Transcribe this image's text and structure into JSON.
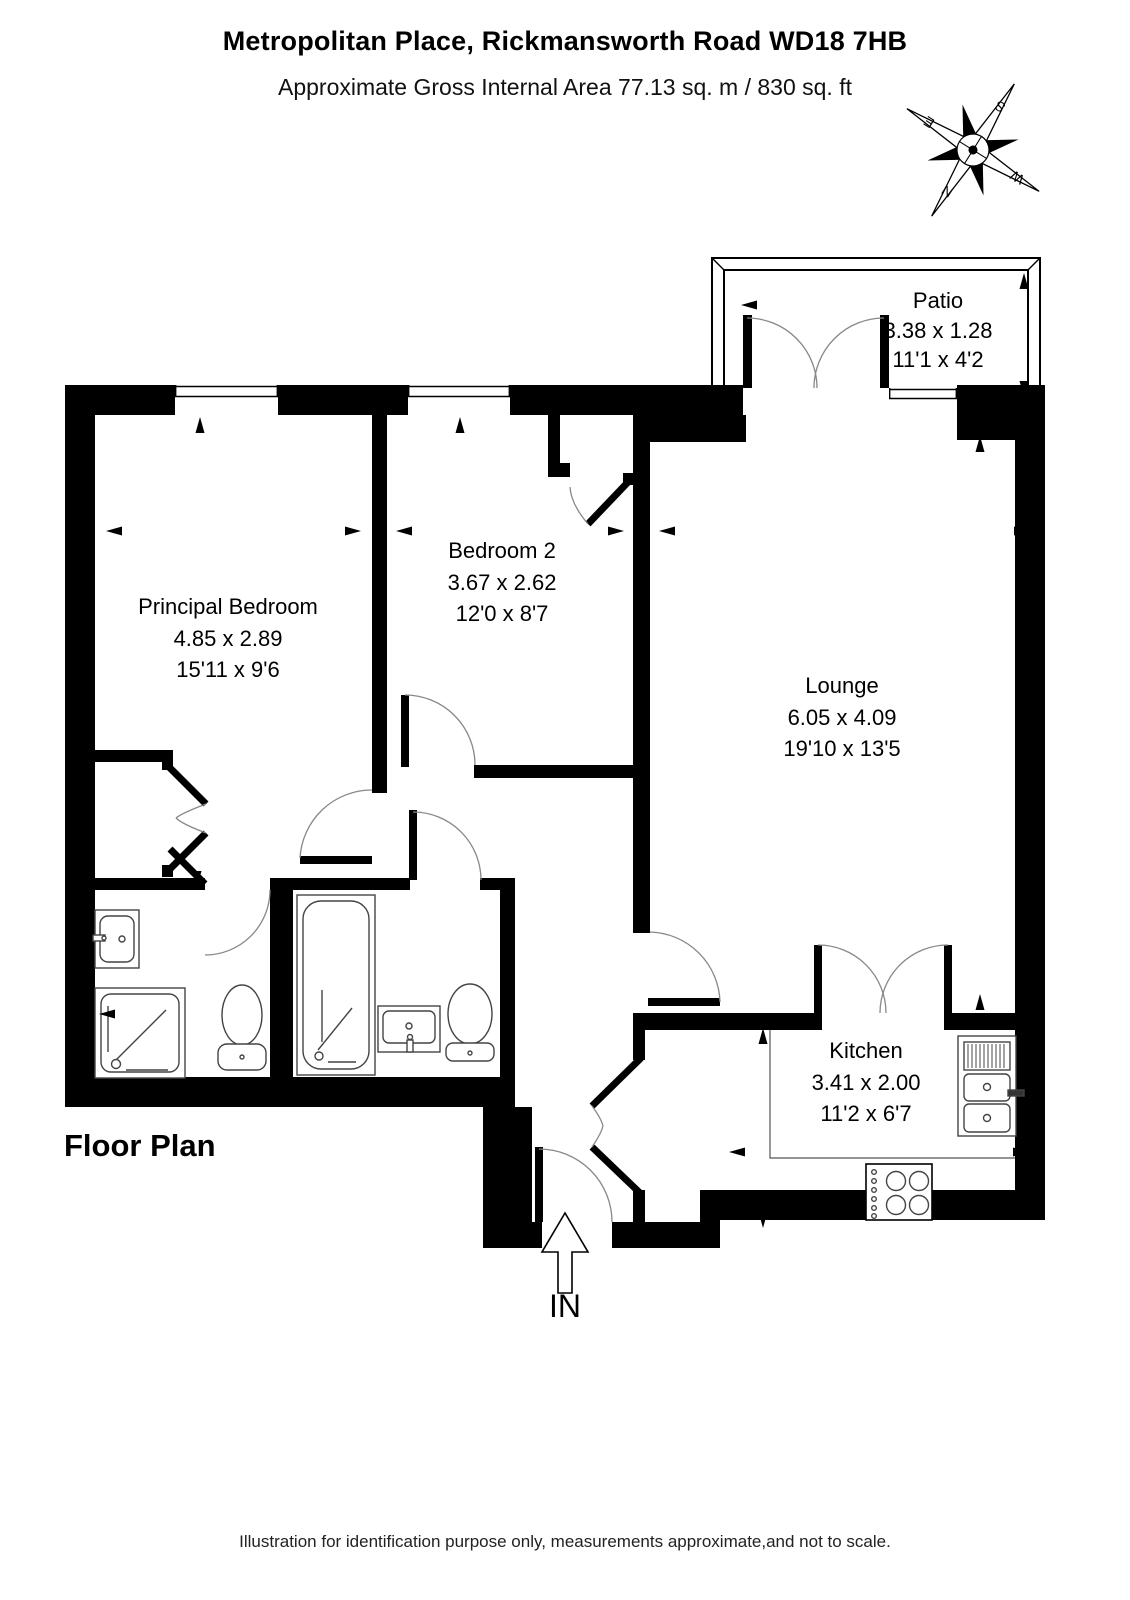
{
  "header": {
    "title": "Metropolitan Place, Rickmansworth Road WD18 7HB",
    "subtitle": "Approximate Gross Internal Area 77.13 sq. m / 830 sq. ft"
  },
  "rooms": {
    "patio": {
      "name": "Patio",
      "metric": "3.38 x 1.28",
      "imperial": "11'1 x 4'2"
    },
    "principal_bedroom": {
      "name": "Principal Bedroom",
      "metric": "4.85 x 2.89",
      "imperial": "15'11 x 9'6"
    },
    "bedroom2": {
      "name": "Bedroom 2",
      "metric": "3.67 x 2.62",
      "imperial": "12'0 x 8'7"
    },
    "lounge": {
      "name": "Lounge",
      "metric": "6.05 x 4.09",
      "imperial": "19'10 x 13'5"
    },
    "kitchen": {
      "name": "Kitchen",
      "metric": "3.41 x 2.00",
      "imperial": "11'2 x 6'7"
    }
  },
  "compass": {
    "n": "N",
    "e": "E",
    "s": "S",
    "w": "W"
  },
  "plan": {
    "label": "Floor Plan",
    "entrance": "IN"
  },
  "footer": {
    "disclaimer": "Illustration for identification purpose only, measurements approximate,and not to scale."
  },
  "colors": {
    "wall": "#000000",
    "background": "#ffffff",
    "fixture_line": "#444444",
    "arc_line": "#888888"
  }
}
